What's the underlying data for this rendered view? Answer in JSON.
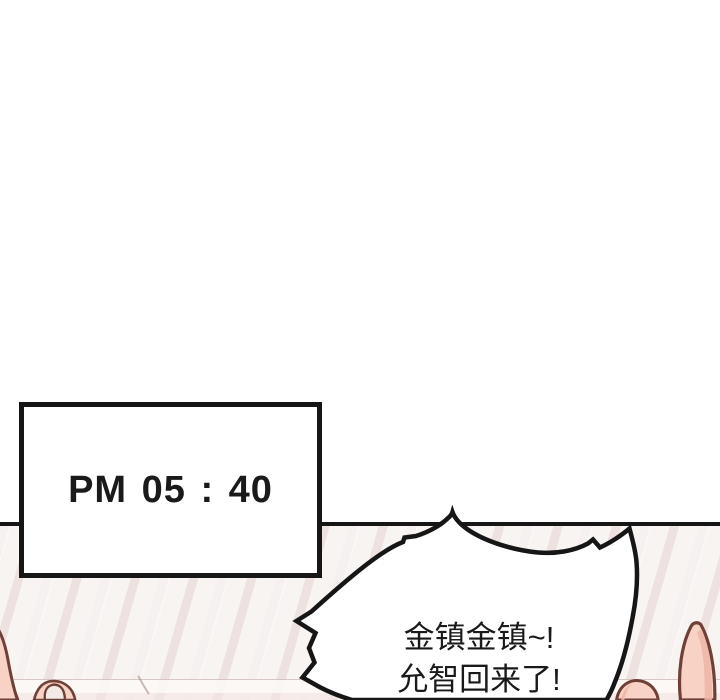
{
  "scene_type": "webtoon-comic-panel",
  "time_card": {
    "label": "PM 05 : 40"
  },
  "speech_bubble": {
    "lines": [
      "金镇金镇~!",
      "允智回来了!"
    ]
  },
  "colors": {
    "ink": "#161616",
    "text": "#1a1a1a",
    "panel_base": "#f8f4f2",
    "stripe_pink": "#eee2e0",
    "skin": "#f8d3c5",
    "skin_shade": "#edb4a6",
    "skin_outline": "#6f4038",
    "nail": "#f3eae6"
  }
}
